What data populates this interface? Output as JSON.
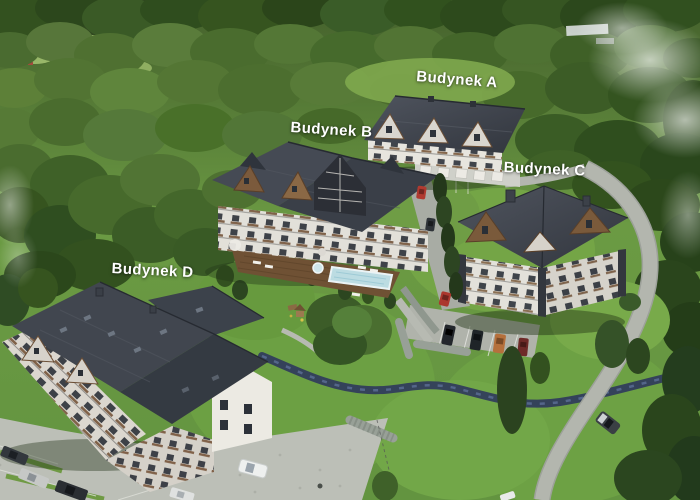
{
  "meta": {
    "kind": "aerial-photograph",
    "description": "Bird's-eye drone view of a wooded mountain estate with four labelled apartment buildings, lawns, a pool terrace, winding roads, a stream and parking areas"
  },
  "labels": [
    {
      "id": "A",
      "text": "Budynek A"
    },
    {
      "id": "B",
      "text": "Budynek B"
    },
    {
      "id": "C",
      "text": "Budynek C"
    },
    {
      "id": "D",
      "text": "Budynek D"
    }
  ],
  "colors": {
    "label_text": "#ffffff",
    "forest_dark": "#2d4520",
    "forest_mid": "#4a6c2e",
    "lawn": "#74a546",
    "roof_dark": "#353a43",
    "roof_light": "#4d525c",
    "facade_white": "#e6e4dd",
    "timber_wood": "#7a5a3c",
    "road_gray": "#b3b6ae",
    "stream_blue": "#323d5c",
    "pool_water": "#bcdce2",
    "car_red": "#b03a30"
  }
}
